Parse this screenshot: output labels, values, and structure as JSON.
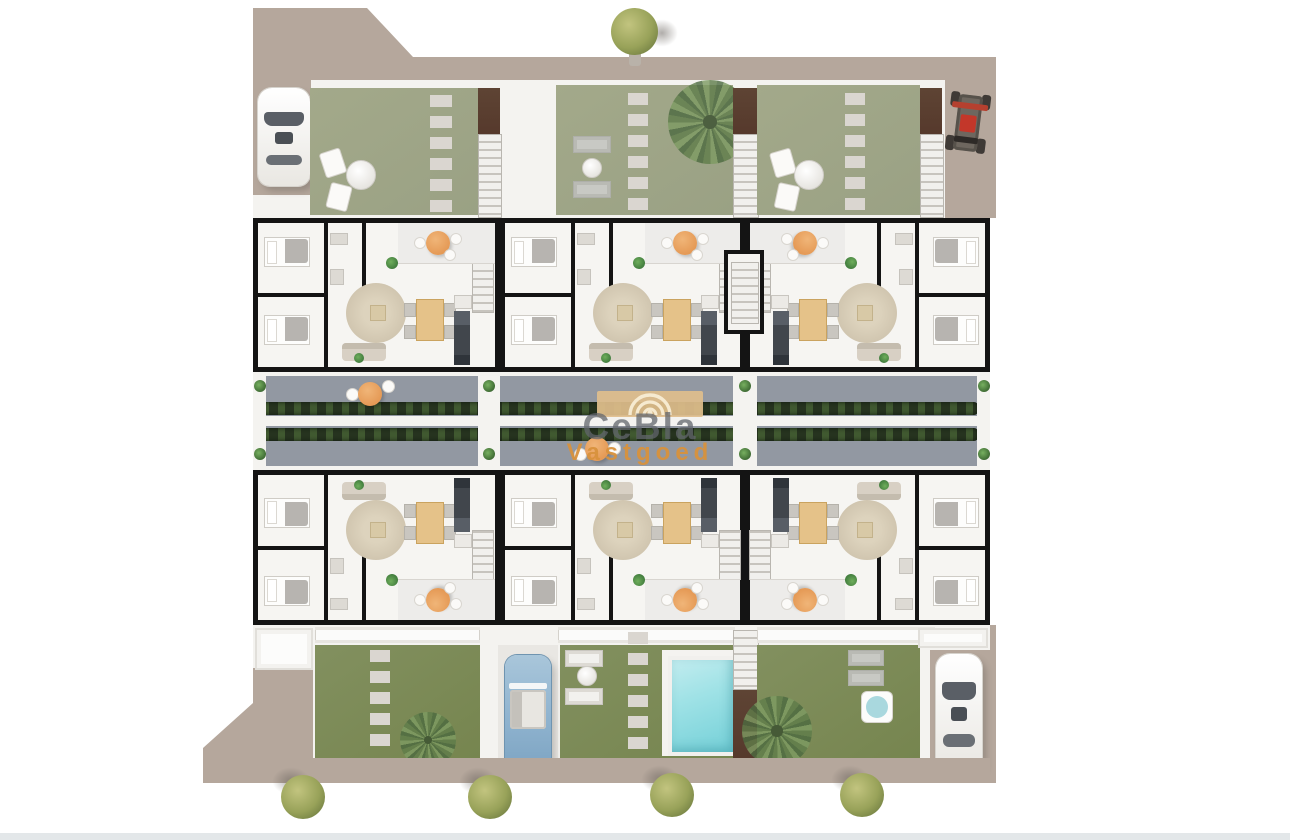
{
  "watermark": {
    "brand": "CeBla",
    "word": "Vastgoed",
    "logo": "concentric-arcs-icon"
  },
  "scene": {
    "type": "top-down 3D architectural floor plan render",
    "units": 6,
    "unit_rows": 2,
    "gardens_top": 3,
    "gardens_bottom": 3,
    "pools": 1,
    "hot_tubs": 1,
    "cars": {
      "white": 2,
      "blue_convertible": 1,
      "red_buggy": 1
    },
    "street_trees_bottom": 4,
    "street_trees_top": 1,
    "central_walkway": "gray terrace band with two hedge planter strips and round orange tables"
  },
  "palette": {
    "ground": "#b5a79c",
    "plate": "#f4f3f0",
    "floor": "#f6f5f2",
    "wall": "#141414",
    "lawn-hazed": "#a3a98a",
    "lawn": "#82905f",
    "terrace": "#9298a2",
    "hedge": "#26331f",
    "stone": "#dad6d0",
    "brown": "#56392c",
    "orange": "#e59a56",
    "wood": "#e5c289",
    "rug": "#cfc4ae",
    "pool-light": "#c2ecef",
    "pool": "#74d0d8",
    "car-blue": "#8fb3cf",
    "buggy-red": "#c3372a",
    "tree1": "#98a259",
    "palm": "#5f7d4a",
    "plantg": "#3f7a3c",
    "bottom-strip": "#e3e7e9"
  }
}
